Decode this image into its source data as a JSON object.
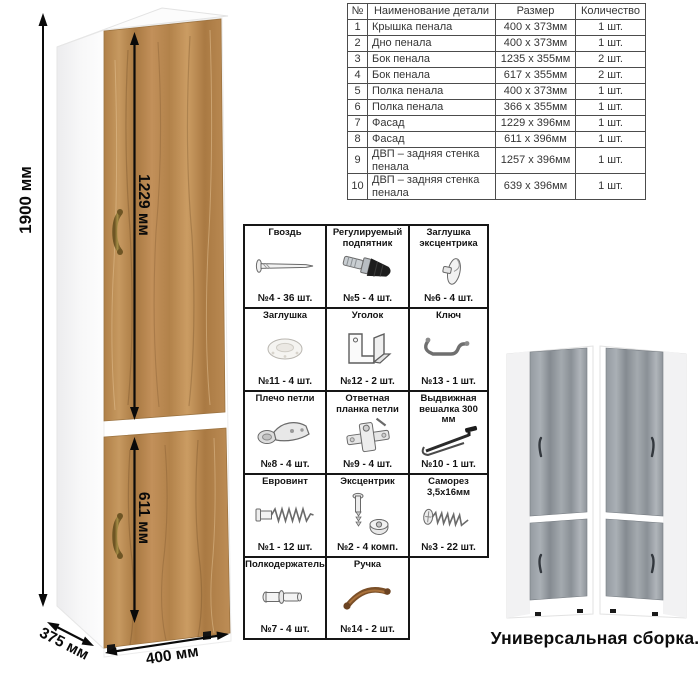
{
  "dimensions": {
    "height": "1900 мм",
    "top_door_height": "1229 мм",
    "bottom_door_height": "611 мм",
    "depth": "375 мм",
    "width": "400 мм"
  },
  "parts_table": {
    "headers": [
      "№",
      "Наименование детали",
      "Размер",
      "Количество"
    ],
    "rows": [
      [
        "1",
        "Крышка пенала",
        "400 x 373мм",
        "1 шт."
      ],
      [
        "2",
        "Дно пенала",
        "400 x 373мм",
        "1 шт."
      ],
      [
        "3",
        "Бок пенала",
        "1235 x 355мм",
        "2 шт."
      ],
      [
        "4",
        "Бок пенала",
        "617 x 355мм",
        "2 шт."
      ],
      [
        "5",
        "Полка пенала",
        "400 x 373мм",
        "1 шт."
      ],
      [
        "6",
        "Полка пенала",
        "366 x 355мм",
        "1 шт."
      ],
      [
        "7",
        "Фасад",
        "1229 x 396мм",
        "1 шт."
      ],
      [
        "8",
        "Фасад",
        "611 x 396мм",
        "1 шт."
      ],
      [
        "9",
        "ДВП – задняя стенка пенала",
        "1257 x 396мм",
        "1 шт."
      ],
      [
        "10",
        "ДВП – задняя стенка пенала",
        "639 x 396мм",
        "1 шт."
      ]
    ]
  },
  "hardware": {
    "items": [
      {
        "name": "Гвоздь",
        "icon": "nail-icon",
        "count": "№4 - 36 шт."
      },
      {
        "name": "Регулируемый подпятник",
        "icon": "adjustable-foot-icon",
        "count": "№5 - 4 шт."
      },
      {
        "name": "Заглушка эксцентрика",
        "icon": "cam-cover-icon",
        "count": "№6 - 4 шт."
      },
      {
        "name": "Заглушка",
        "icon": "cap-icon",
        "count": "№11 - 4 шт."
      },
      {
        "name": "Уголок",
        "icon": "corner-bracket-icon",
        "count": "№12 - 2 шт."
      },
      {
        "name": "Ключ",
        "icon": "hex-key-icon",
        "count": "№13 - 1 шт."
      },
      {
        "name": "Плечо петли",
        "icon": "hinge-arm-icon",
        "count": "№8 - 4 шт."
      },
      {
        "name": "Ответная планка петли",
        "icon": "hinge-plate-icon",
        "count": "№9 - 4 шт."
      },
      {
        "name": "Выдвижная вешалка 300 мм",
        "icon": "hanger-rod-icon",
        "count": "№10 - 1 шт."
      },
      {
        "name": "Евровинт",
        "icon": "euroscrew-icon",
        "count": "№1 - 12 шт."
      },
      {
        "name": "Эксцентрик",
        "icon": "cam-lock-icon",
        "count": "№2 - 4 комп."
      },
      {
        "name": "Саморез 3,5х16мм",
        "icon": "screw-icon",
        "count": "№3 - 22 шт."
      },
      {
        "name": "Полкодержатель",
        "icon": "shelf-pin-icon",
        "count": "№7 - 4 шт."
      },
      {
        "name": "Ручка",
        "icon": "handle-icon",
        "count": "№14 - 2 шт."
      }
    ]
  },
  "footer": {
    "caption": "Универсальная сборка."
  },
  "colors": {
    "wood": "#b9894e",
    "wood_dark": "#a4763f",
    "wood_light": "#cb9c63",
    "gray_wood": "#9aa0a6",
    "gray_wood_dark": "#878d93",
    "bronze_handle": "#8a6a30",
    "line_black": "#111111"
  }
}
